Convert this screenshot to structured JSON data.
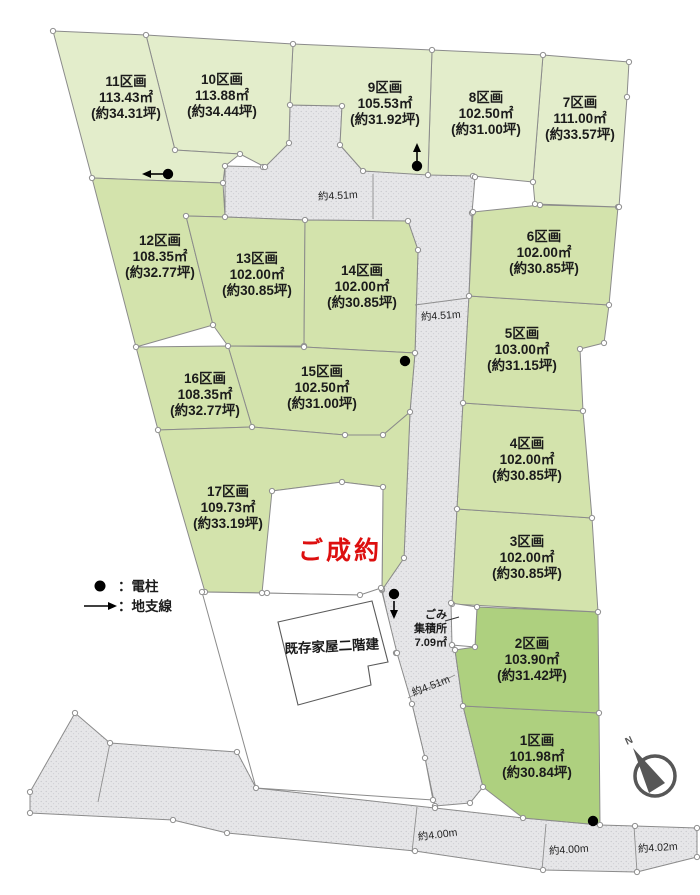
{
  "map": {
    "width": 700,
    "height": 895,
    "colors": {
      "plot_pale": "#e3edcb",
      "plot_mid": "#d3e3ac",
      "plot_dark": "#aed07f",
      "road_fill": "#e6e6e8",
      "road_dot": "#c5c5cb",
      "stroke": "#8b8b8b",
      "node_fill": "#ffffff",
      "sold_red": "#dd0f0f",
      "ink": "#1b1b1b",
      "compass": "#575757"
    },
    "plots": [
      {
        "id": "1",
        "name": "1区画",
        "area": "101.98㎡",
        "tsubo": "(約30.84坪)",
        "tone": "dark",
        "label": [
          537,
          757
        ],
        "pts": [
          [
            463,
            706
          ],
          [
            599,
            713
          ],
          [
            600,
            825
          ],
          [
            523,
            818
          ],
          [
            483,
            787
          ]
        ]
      },
      {
        "id": "2",
        "name": "2区画",
        "area": "103.90㎡",
        "tsubo": "(約31.42坪)",
        "tone": "dark",
        "label": [
          532,
          660
        ],
        "pts": [
          [
            477,
            607
          ],
          [
            598,
            612
          ],
          [
            599,
            713
          ],
          [
            463,
            706
          ],
          [
            455,
            650
          ],
          [
            475,
            647
          ]
        ]
      },
      {
        "id": "3",
        "name": "3区画",
        "area": "102.00㎡",
        "tsubo": "(約30.85坪)",
        "tone": "mid",
        "label": [
          527,
          558
        ],
        "pts": [
          [
            457,
            509
          ],
          [
            592,
            518
          ],
          [
            598,
            612
          ],
          [
            452,
            604
          ]
        ]
      },
      {
        "id": "4",
        "name": "4区画",
        "area": "102.00㎡",
        "tsubo": "(約30.85坪)",
        "tone": "mid",
        "label": [
          527,
          460
        ],
        "pts": [
          [
            463,
            403
          ],
          [
            583,
            411
          ],
          [
            592,
            518
          ],
          [
            457,
            509
          ]
        ]
      },
      {
        "id": "5",
        "name": "5区画",
        "area": "103.00㎡",
        "tsubo": "(約31.15坪)",
        "tone": "mid",
        "label": [
          522,
          350
        ],
        "pts": [
          [
            469,
            296
          ],
          [
            609,
            305
          ],
          [
            604,
            343
          ],
          [
            580,
            349
          ],
          [
            583,
            411
          ],
          [
            463,
            403
          ]
        ]
      },
      {
        "id": "6",
        "name": "6区画",
        "area": "102.00㎡",
        "tsubo": "(約30.85坪)",
        "tone": "mid",
        "label": [
          544,
          253
        ],
        "pts": [
          [
            473,
            212
          ],
          [
            540,
            205
          ],
          [
            618,
            207
          ],
          [
            609,
            305
          ],
          [
            469,
            296
          ]
        ]
      },
      {
        "id": "7",
        "name": "7区画",
        "area": "111.00㎡",
        "tsubo": "(約33.57坪)",
        "tone": "pale",
        "label": [
          580,
          119
        ],
        "pts": [
          [
            543,
            55
          ],
          [
            629,
            62
          ],
          [
            627,
            97
          ],
          [
            619,
            207
          ],
          [
            535,
            204
          ],
          [
            533,
            182
          ]
        ]
      },
      {
        "id": "8",
        "name": "8区画",
        "area": "102.50㎡",
        "tsubo": "(約31.00坪)",
        "tone": "pale",
        "label": [
          486,
          114
        ],
        "pts": [
          [
            432,
            50
          ],
          [
            543,
            55
          ],
          [
            533,
            182
          ],
          [
            473,
            176
          ],
          [
            428,
            175
          ]
        ]
      },
      {
        "id": "9",
        "name": "9区画",
        "area": "105.53㎡",
        "tsubo": "(約31.92坪)",
        "tone": "pale",
        "label": [
          385,
          104
        ],
        "pts": [
          [
            293,
            44
          ],
          [
            432,
            50
          ],
          [
            428,
            175
          ],
          [
            363,
            171
          ],
          [
            340,
            145
          ],
          [
            342,
            106
          ],
          [
            290,
            105
          ]
        ]
      },
      {
        "id": "10",
        "name": "10区画",
        "area": "113.88㎡",
        "tsubo": "(約34.44坪)",
        "tone": "pale",
        "label": [
          222,
          96
        ],
        "pts": [
          [
            146,
            35
          ],
          [
            293,
            44
          ],
          [
            290,
            105
          ],
          [
            289,
            143
          ],
          [
            265,
            167
          ],
          [
            240,
            154
          ],
          [
            175,
            150
          ]
        ]
      },
      {
        "id": "11",
        "name": "11区画",
        "area": "113.43㎡",
        "tsubo": "(約34.31坪)",
        "tone": "pale",
        "label": [
          126,
          98
        ],
        "pts": [
          [
            53,
            31
          ],
          [
            146,
            35
          ],
          [
            175,
            150
          ],
          [
            240,
            154
          ],
          [
            225,
            166
          ],
          [
            223,
            183
          ],
          [
            92,
            178
          ]
        ]
      },
      {
        "id": "12",
        "name": "12区画",
        "area": "108.35㎡",
        "tsubo": "(約32.77坪)",
        "tone": "mid",
        "label": [
          160,
          257
        ],
        "pts": [
          [
            92,
            178
          ],
          [
            223,
            183
          ],
          [
            225,
            217
          ],
          [
            186,
            216
          ],
          [
            213,
            325
          ],
          [
            136,
            347
          ]
        ]
      },
      {
        "id": "13",
        "name": "13区画",
        "area": "102.00㎡",
        "tsubo": "(約30.85坪)",
        "tone": "mid",
        "label": [
          257,
          275
        ],
        "pts": [
          [
            186,
            216
          ],
          [
            225,
            217
          ],
          [
            305,
            220
          ],
          [
            304,
            346
          ],
          [
            228,
            346
          ],
          [
            213,
            325
          ]
        ]
      },
      {
        "id": "14",
        "name": "14区画",
        "area": "102.00㎡",
        "tsubo": "(約30.85坪)",
        "tone": "mid",
        "label": [
          362,
          287
        ],
        "pts": [
          [
            305,
            220
          ],
          [
            408,
            221
          ],
          [
            418,
            250
          ],
          [
            415,
            353
          ],
          [
            304,
            347
          ]
        ]
      },
      {
        "id": "15",
        "name": "15区画",
        "area": "102.50㎡",
        "tsubo": "(約31.00坪)",
        "tone": "mid",
        "label": [
          322,
          388
        ],
        "pts": [
          [
            228,
            346
          ],
          [
            304,
            347
          ],
          [
            415,
            353
          ],
          [
            410,
            412
          ],
          [
            383,
            435
          ],
          [
            345,
            435
          ],
          [
            252,
            427
          ]
        ]
      },
      {
        "id": "16",
        "name": "16区画",
        "area": "108.35㎡",
        "tsubo": "(約32.77坪)",
        "tone": "mid",
        "label": [
          205,
          395
        ],
        "pts": [
          [
            136,
            347
          ],
          [
            228,
            346
          ],
          [
            252,
            427
          ],
          [
            158,
            430
          ]
        ]
      },
      {
        "id": "17",
        "name": "17区画",
        "area": "109.73㎡",
        "tsubo": "(約33.19坪)",
        "tone": "mid",
        "label": [
          228,
          508
        ],
        "pts": [
          [
            158,
            430
          ],
          [
            252,
            427
          ],
          [
            345,
            435
          ],
          [
            383,
            435
          ],
          [
            410,
            412
          ],
          [
            404,
            558
          ],
          [
            382,
            590
          ],
          [
            383,
            487
          ],
          [
            342,
            482
          ],
          [
            272,
            491
          ],
          [
            267,
            593
          ],
          [
            205,
            592
          ]
        ]
      }
    ],
    "roads": {
      "main": [
        [
          225,
          166
        ],
        [
          263,
          167
        ],
        [
          289,
          143
        ],
        [
          290,
          105
        ],
        [
          342,
          106
        ],
        [
          340,
          145
        ],
        [
          363,
          171
        ],
        [
          473,
          176
        ],
        [
          475,
          177
        ],
        [
          472,
          213
        ],
        [
          469,
          296
        ],
        [
          463,
          403
        ],
        [
          457,
          509
        ],
        [
          452,
          604
        ],
        [
          455,
          650
        ],
        [
          463,
          706
        ],
        [
          483,
          787
        ],
        [
          470,
          803
        ],
        [
          435,
          806
        ],
        [
          425,
          758
        ],
        [
          412,
          704
        ],
        [
          396,
          653
        ],
        [
          382,
          590
        ],
        [
          404,
          558
        ],
        [
          410,
          412
        ],
        [
          415,
          353
        ],
        [
          418,
          250
        ],
        [
          408,
          221
        ],
        [
          305,
          220
        ],
        [
          225,
          217
        ]
      ],
      "bottom": [
        [
          75,
          713
        ],
        [
          110,
          743
        ],
        [
          237,
          752
        ],
        [
          256,
          788
        ],
        [
          435,
          808
        ],
        [
          523,
          818
        ],
        [
          600,
          825
        ],
        [
          635,
          826
        ],
        [
          697,
          828
        ],
        [
          697,
          857
        ],
        [
          637,
          872
        ],
        [
          543,
          870
        ],
        [
          415,
          851
        ],
        [
          227,
          833
        ],
        [
          173,
          820
        ],
        [
          30,
          813
        ],
        [
          30,
          792
        ]
      ]
    },
    "white_lots": {
      "sold_lot": [
        [
          272,
          491
        ],
        [
          342,
          482
        ],
        [
          383,
          487
        ],
        [
          382,
          589
        ],
        [
          360,
          595
        ],
        [
          262,
          593
        ]
      ],
      "house_lot": [
        [
          202,
          592
        ],
        [
          262,
          593
        ],
        [
          360,
          595
        ],
        [
          381,
          588
        ],
        [
          397,
          653
        ],
        [
          412,
          704
        ],
        [
          425,
          758
        ],
        [
          433,
          800
        ],
        [
          256,
          788
        ]
      ]
    },
    "house": {
      "pts": [
        [
          278,
          622
        ],
        [
          372,
          601
        ],
        [
          388,
          662
        ],
        [
          368,
          666
        ],
        [
          371,
          685
        ],
        [
          298,
          705
        ]
      ],
      "label": "既存家屋二階建",
      "lx": 332,
      "ly": 651,
      "rot": -3
    },
    "sold": {
      "text": "ご成約",
      "x": 340,
      "y": 559
    },
    "gomi": {
      "lines": [
        "ごみ",
        "集積所",
        "7.09㎡"
      ],
      "x": 447,
      "ys": [
        618,
        632,
        646
      ],
      "box": [
        [
          451,
          603
        ],
        [
          477,
          607
        ],
        [
          475,
          647
        ],
        [
          452,
          645
        ]
      ],
      "pointer": [
        [
          445,
          621
        ],
        [
          459,
          617
        ]
      ]
    },
    "road_labels": [
      {
        "text": "約4.51m",
        "x": 338,
        "y": 199,
        "rot": -3
      },
      {
        "text": "約4.51m",
        "x": 441,
        "y": 319,
        "rot": -4
      },
      {
        "text": "約4.51m",
        "x": 432,
        "y": 689,
        "rot": -21
      },
      {
        "text": "約4.00m",
        "x": 438,
        "y": 838,
        "rot": -7
      },
      {
        "text": "約4.00m",
        "x": 569,
        "y": 853,
        "rot": -4
      },
      {
        "text": "約4.02m",
        "x": 658,
        "y": 851,
        "rot": -4
      }
    ],
    "dim_lines": [
      [
        [
          373,
          174
        ],
        [
          373,
          219
        ]
      ],
      [
        [
          415,
          305
        ],
        [
          468,
          298
        ]
      ],
      [
        [
          408,
          698
        ],
        [
          455,
          675
        ]
      ],
      [
        [
          110,
          743
        ],
        [
          98,
          802
        ]
      ],
      [
        [
          417,
          807
        ],
        [
          412,
          852
        ]
      ],
      [
        [
          546,
          824
        ],
        [
          542,
          870
        ]
      ],
      [
        [
          634,
          826
        ],
        [
          637,
          872
        ]
      ]
    ],
    "poles": [
      [
        168,
        174
      ],
      [
        417,
        166
      ],
      [
        405,
        361
      ],
      [
        394,
        594
      ],
      [
        593,
        821
      ]
    ],
    "pole_arrows": [
      {
        "line": [
          [
            164,
            174
          ],
          [
            149,
            174
          ]
        ],
        "dir": "left"
      },
      {
        "line": [
          [
            417,
            161
          ],
          [
            417,
            150
          ]
        ],
        "dir": "up"
      },
      {
        "line": [
          [
            394,
            601
          ],
          [
            394,
            612
          ]
        ],
        "dir": "down"
      }
    ],
    "legend": {
      "dot_label": "：電柱",
      "arrow_label": "：地支線",
      "dot_xy": [
        100,
        586
      ],
      "arrow_line": [
        [
          84,
          606
        ],
        [
          110,
          606
        ]
      ],
      "text_x": 118,
      "dot_ty": 591,
      "arrow_ty": 611
    },
    "compass": {
      "cx": 655,
      "cy": 776,
      "r": 20,
      "label": "N"
    }
  }
}
